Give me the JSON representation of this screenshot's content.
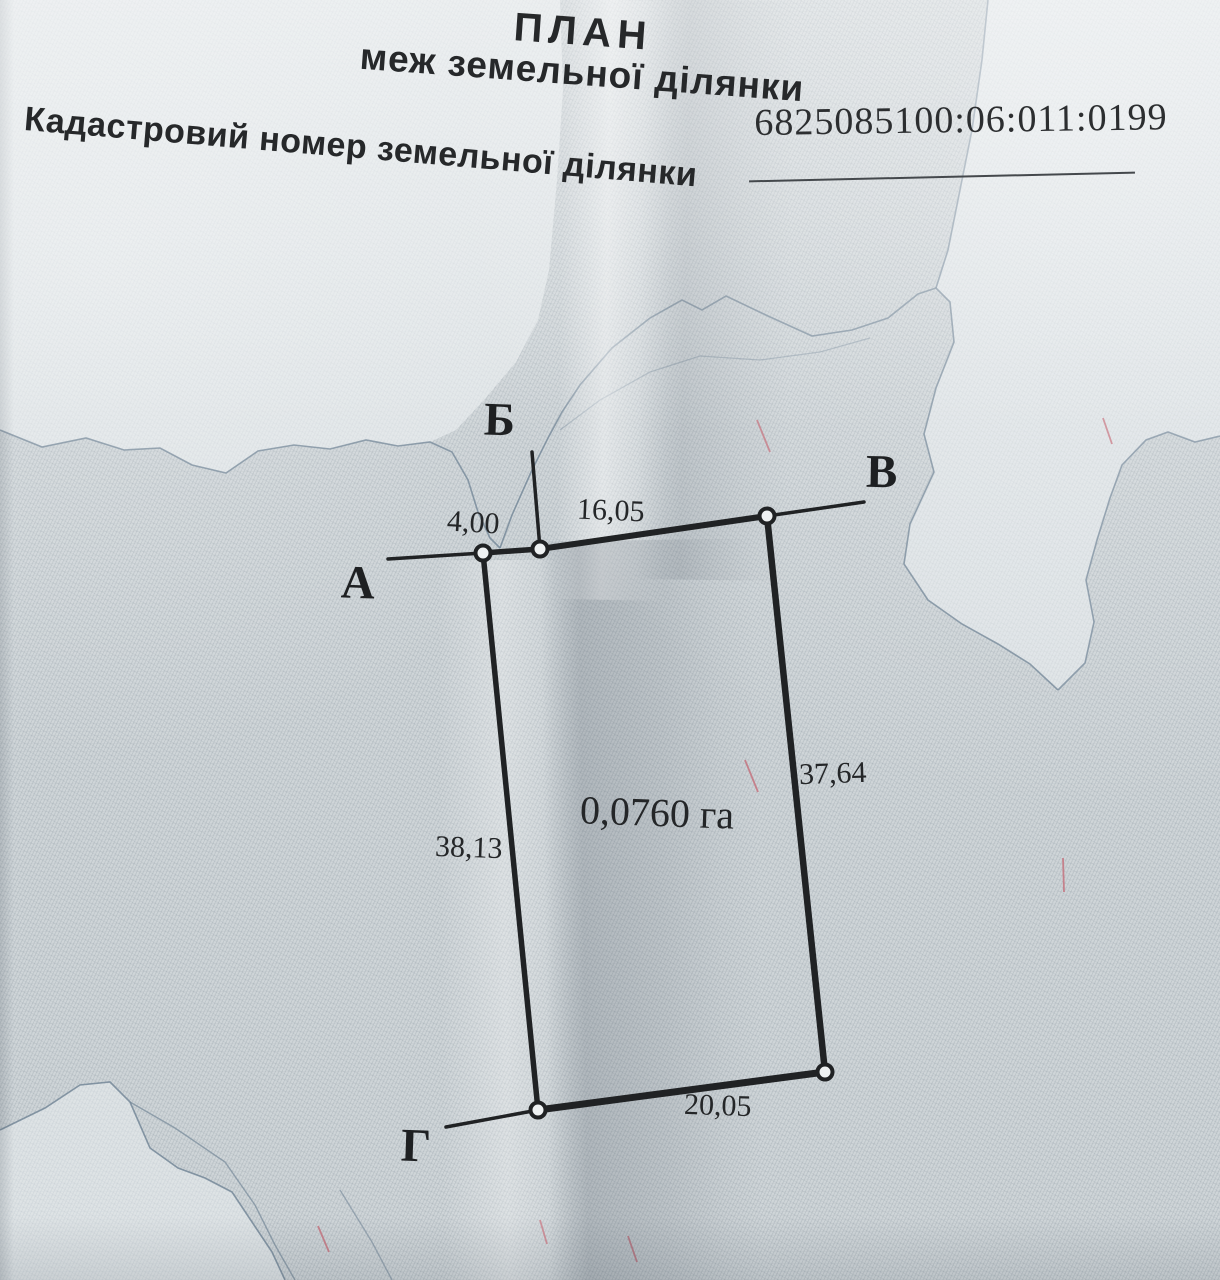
{
  "document": {
    "title_line1": "ПЛАН",
    "title_line2": "меж земельної ділянки",
    "cadastral": {
      "label": "Кадастровий номер земельної ділянки",
      "number": "6825085100:06:011:0199"
    }
  },
  "plan": {
    "area_label": "0,0760 га",
    "vertices": {
      "a": "А",
      "b": "Б",
      "v": "В",
      "g": "Г"
    },
    "lengths": {
      "a_b": "4,00",
      "b_v": "16,05",
      "right_side": "37,64",
      "left_side": "38,13",
      "bottom_side": "20,05"
    }
  },
  "colors": {
    "paper": "#cfd5d8",
    "paper_light": "#e8eced",
    "ink": "#202224",
    "guilloche_line": "#6e8294",
    "security_fiber": "#c4737f"
  }
}
